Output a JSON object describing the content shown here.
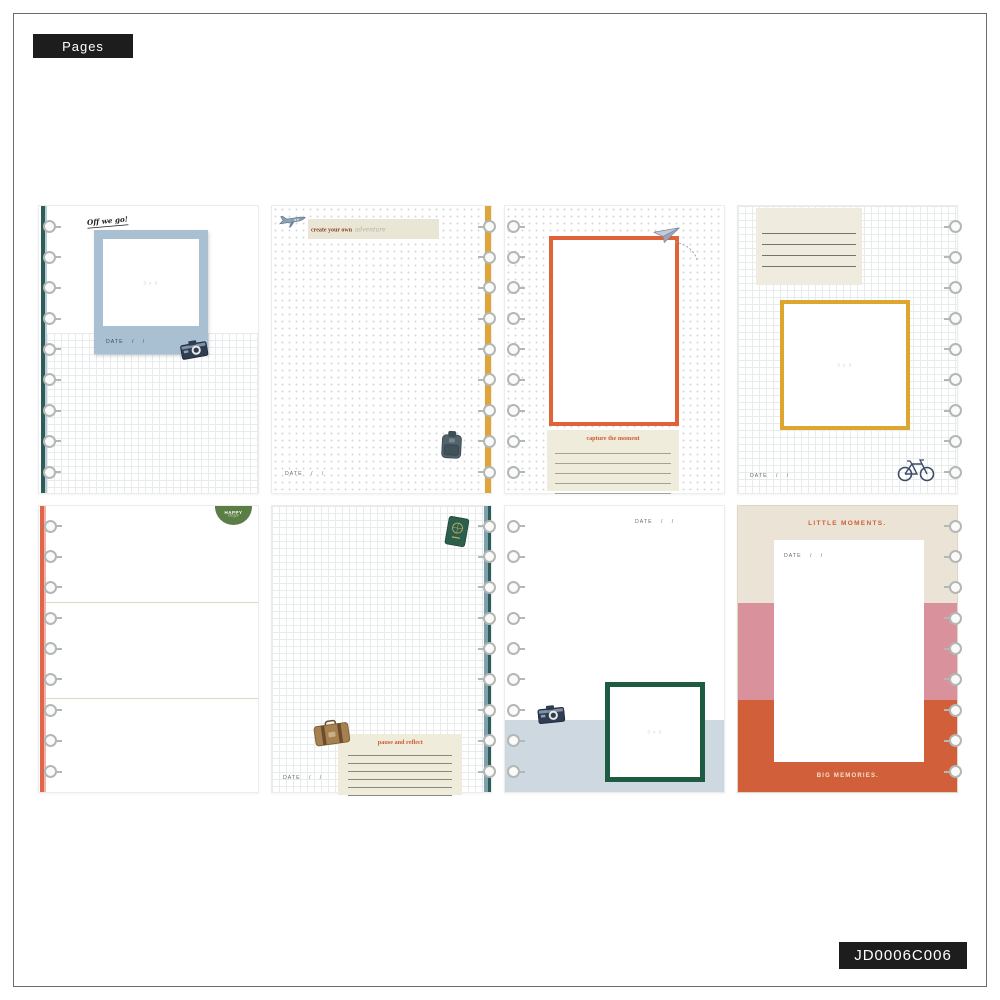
{
  "header_label": "Pages",
  "sku": "JD0006C006",
  "shared": {
    "date_label": "DATE",
    "slash": "/",
    "photo_placeholder": "3 x 3"
  },
  "palette": {
    "tag_black": "#1d1d1d",
    "teal_spine": "#2e5c59",
    "blue_polaroid_frame": "#a9c0d2",
    "yellow_spine": "#dfa53a",
    "orange_frame": "#df6238",
    "yellow_frame": "#dfa62f",
    "coral_spine": "#e0654c",
    "badge_green": "#5b7d46",
    "dark_green_frame": "#1d5b42",
    "light_blue_band": "#cdd8e1",
    "cream_band": "#ebe4d6",
    "pink_band": "#d9929b",
    "orange_band": "#d15f3a",
    "cream_box": "#efecdb",
    "title_orange": "#cc5c31"
  },
  "pages": {
    "p1": {
      "script_title": "Off we go!"
    },
    "p2": {
      "title_bold": "create your own",
      "title_script": "adventure"
    },
    "p3": {
      "box_title": "capture the moment"
    },
    "p5": {
      "badge_top": "HAPPY",
      "badge_script": "days"
    },
    "p6": {
      "box_title": "pause and reflect"
    },
    "p8": {
      "top_title": "LITTLE MOMENTS.",
      "bottom_title": "BIG MEMORIES."
    }
  }
}
